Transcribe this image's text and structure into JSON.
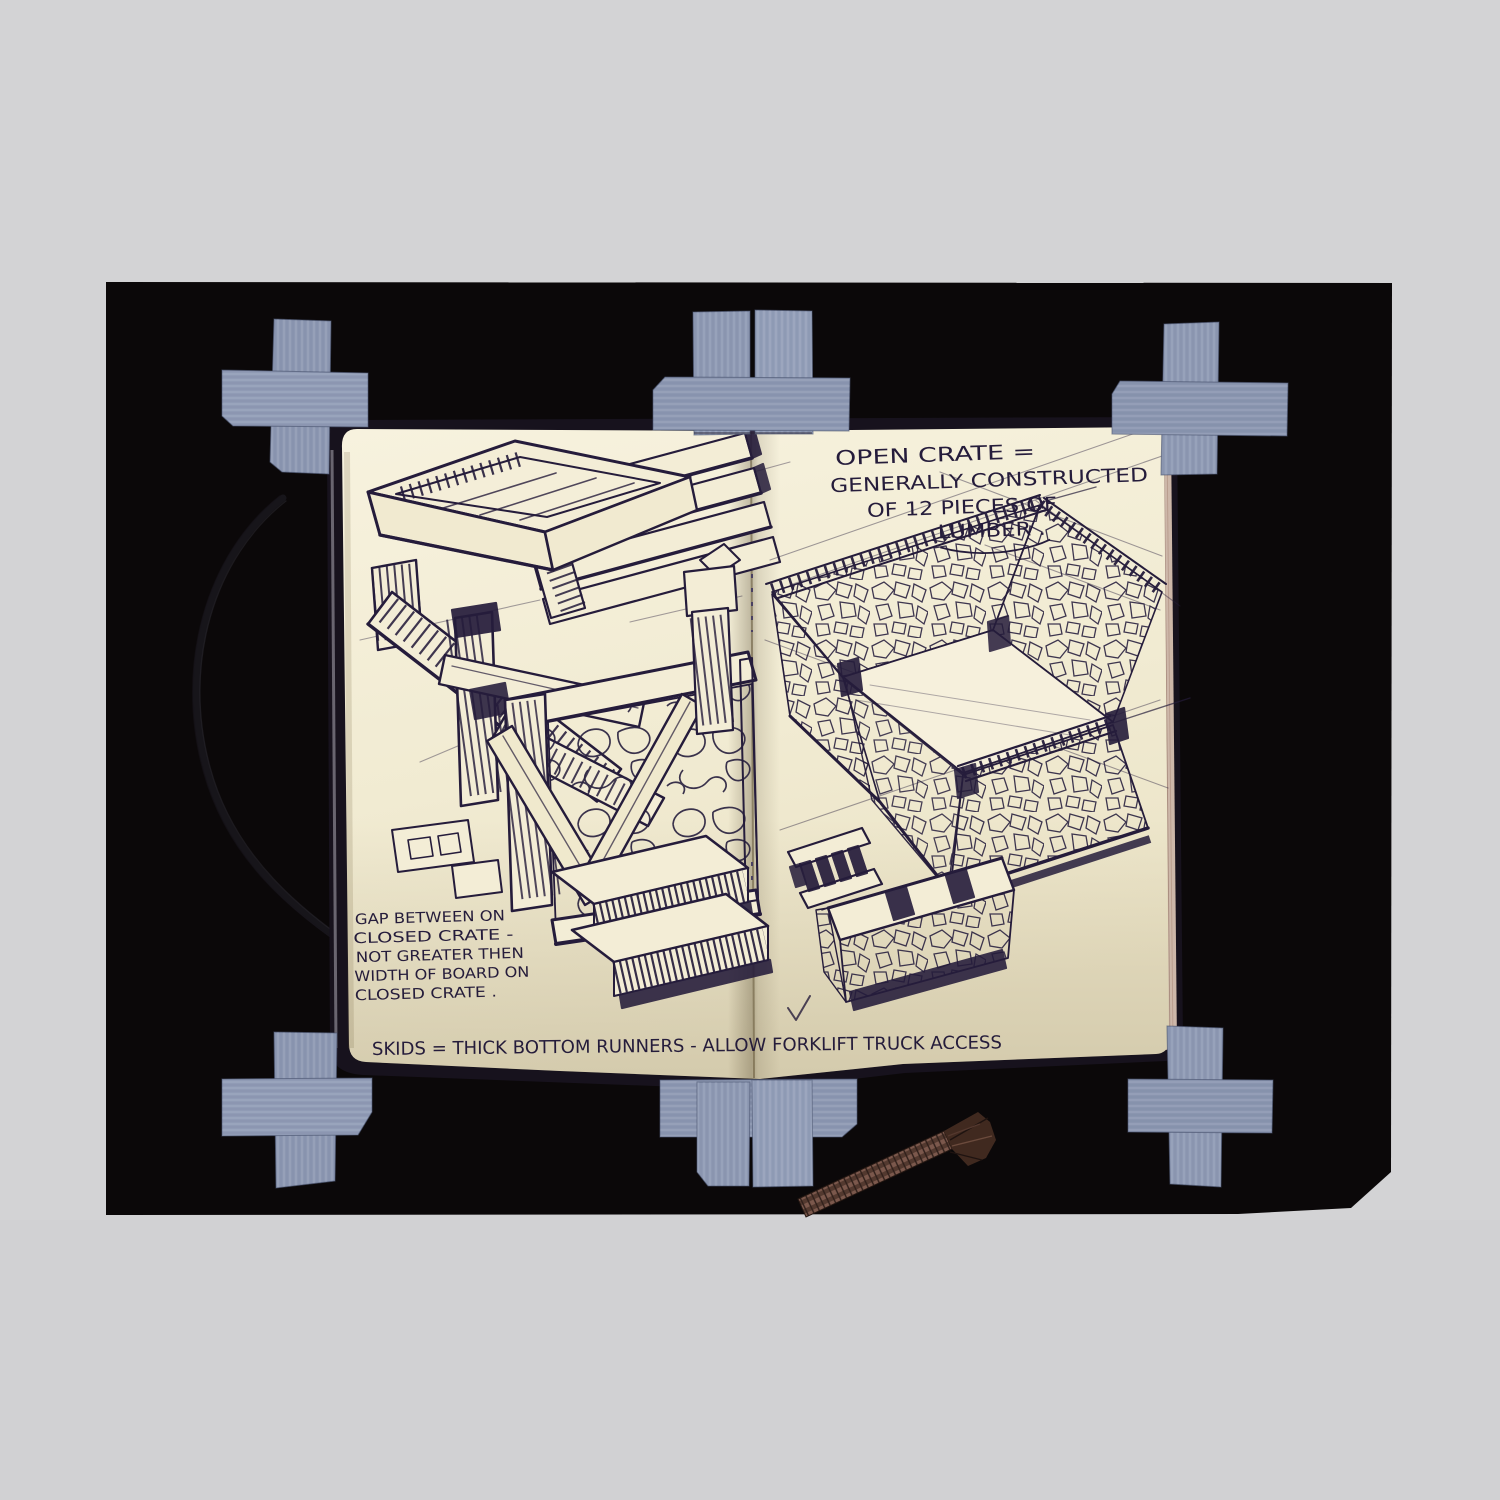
{
  "scene": {
    "description": "Open sketchbook spread with ink drawings of shipping crates, taped to a black board with blue-gray tape crosses, on a light gray scanner background",
    "background_color": "#d3d3d5",
    "board_color": "#0b0809",
    "tape_color": "#8e99b3",
    "paper_color": "#f3edd6",
    "ink_color": "#251c3b",
    "cord_color": "#6f4e44"
  },
  "annotations": {
    "open_crate_note": {
      "line1": "OPEN CRATE =",
      "line2": "GENERALLY CONSTRUCTED",
      "line3": "OF 12 PIECES OF",
      "line4": "LUMBER ."
    },
    "gap_note": {
      "line1": "GAP BETWEEN ON",
      "line2": "CLOSED CRATE -",
      "line3": "NOT GREATER THEN",
      "line4": "WIDTH OF BOARD ON",
      "line5": "CLOSED CRATE ."
    },
    "skids_note": "SKIDS = THICK BOTTOM RUNNERS - ALLOW FORKLIFT TRUCK ACCESS"
  }
}
